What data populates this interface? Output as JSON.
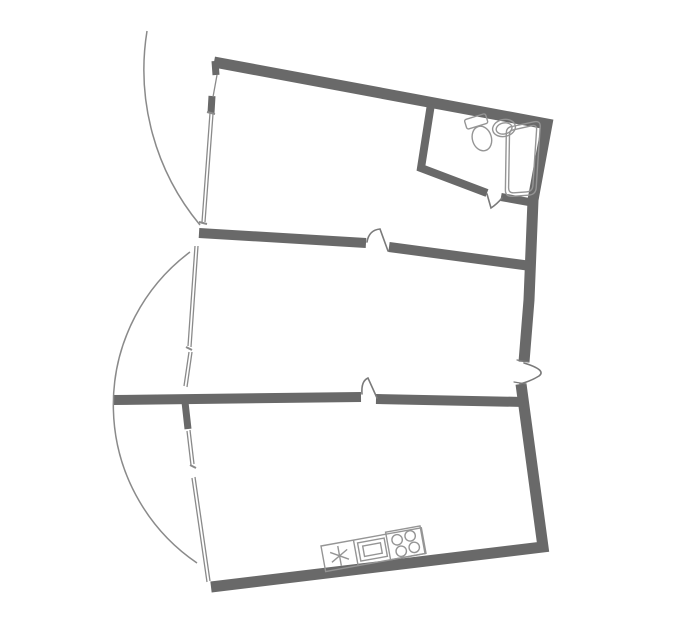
{
  "floor_plan": {
    "type": "apartment-floor-plan",
    "background": "#ffffff",
    "wall_color": "#696969",
    "line_color": "#8a8a8a",
    "door_color": "#7a7a7a",
    "fixture_color": "#959595",
    "rooms": [
      {
        "name": "upper room with en-suite bathroom"
      },
      {
        "name": "middle room"
      },
      {
        "name": "lower room with kitchen counter"
      },
      {
        "name": "bathroom"
      }
    ],
    "fixtures": [
      "toilet",
      "washbasin",
      "bathtub",
      "kitchen sink",
      "oven",
      "4-burner cooktop"
    ],
    "doors": [
      "upper divider door",
      "lower divider door",
      "bathroom door",
      "entrance door"
    ],
    "window_sections": 3,
    "balcony_arcs": 2
  }
}
